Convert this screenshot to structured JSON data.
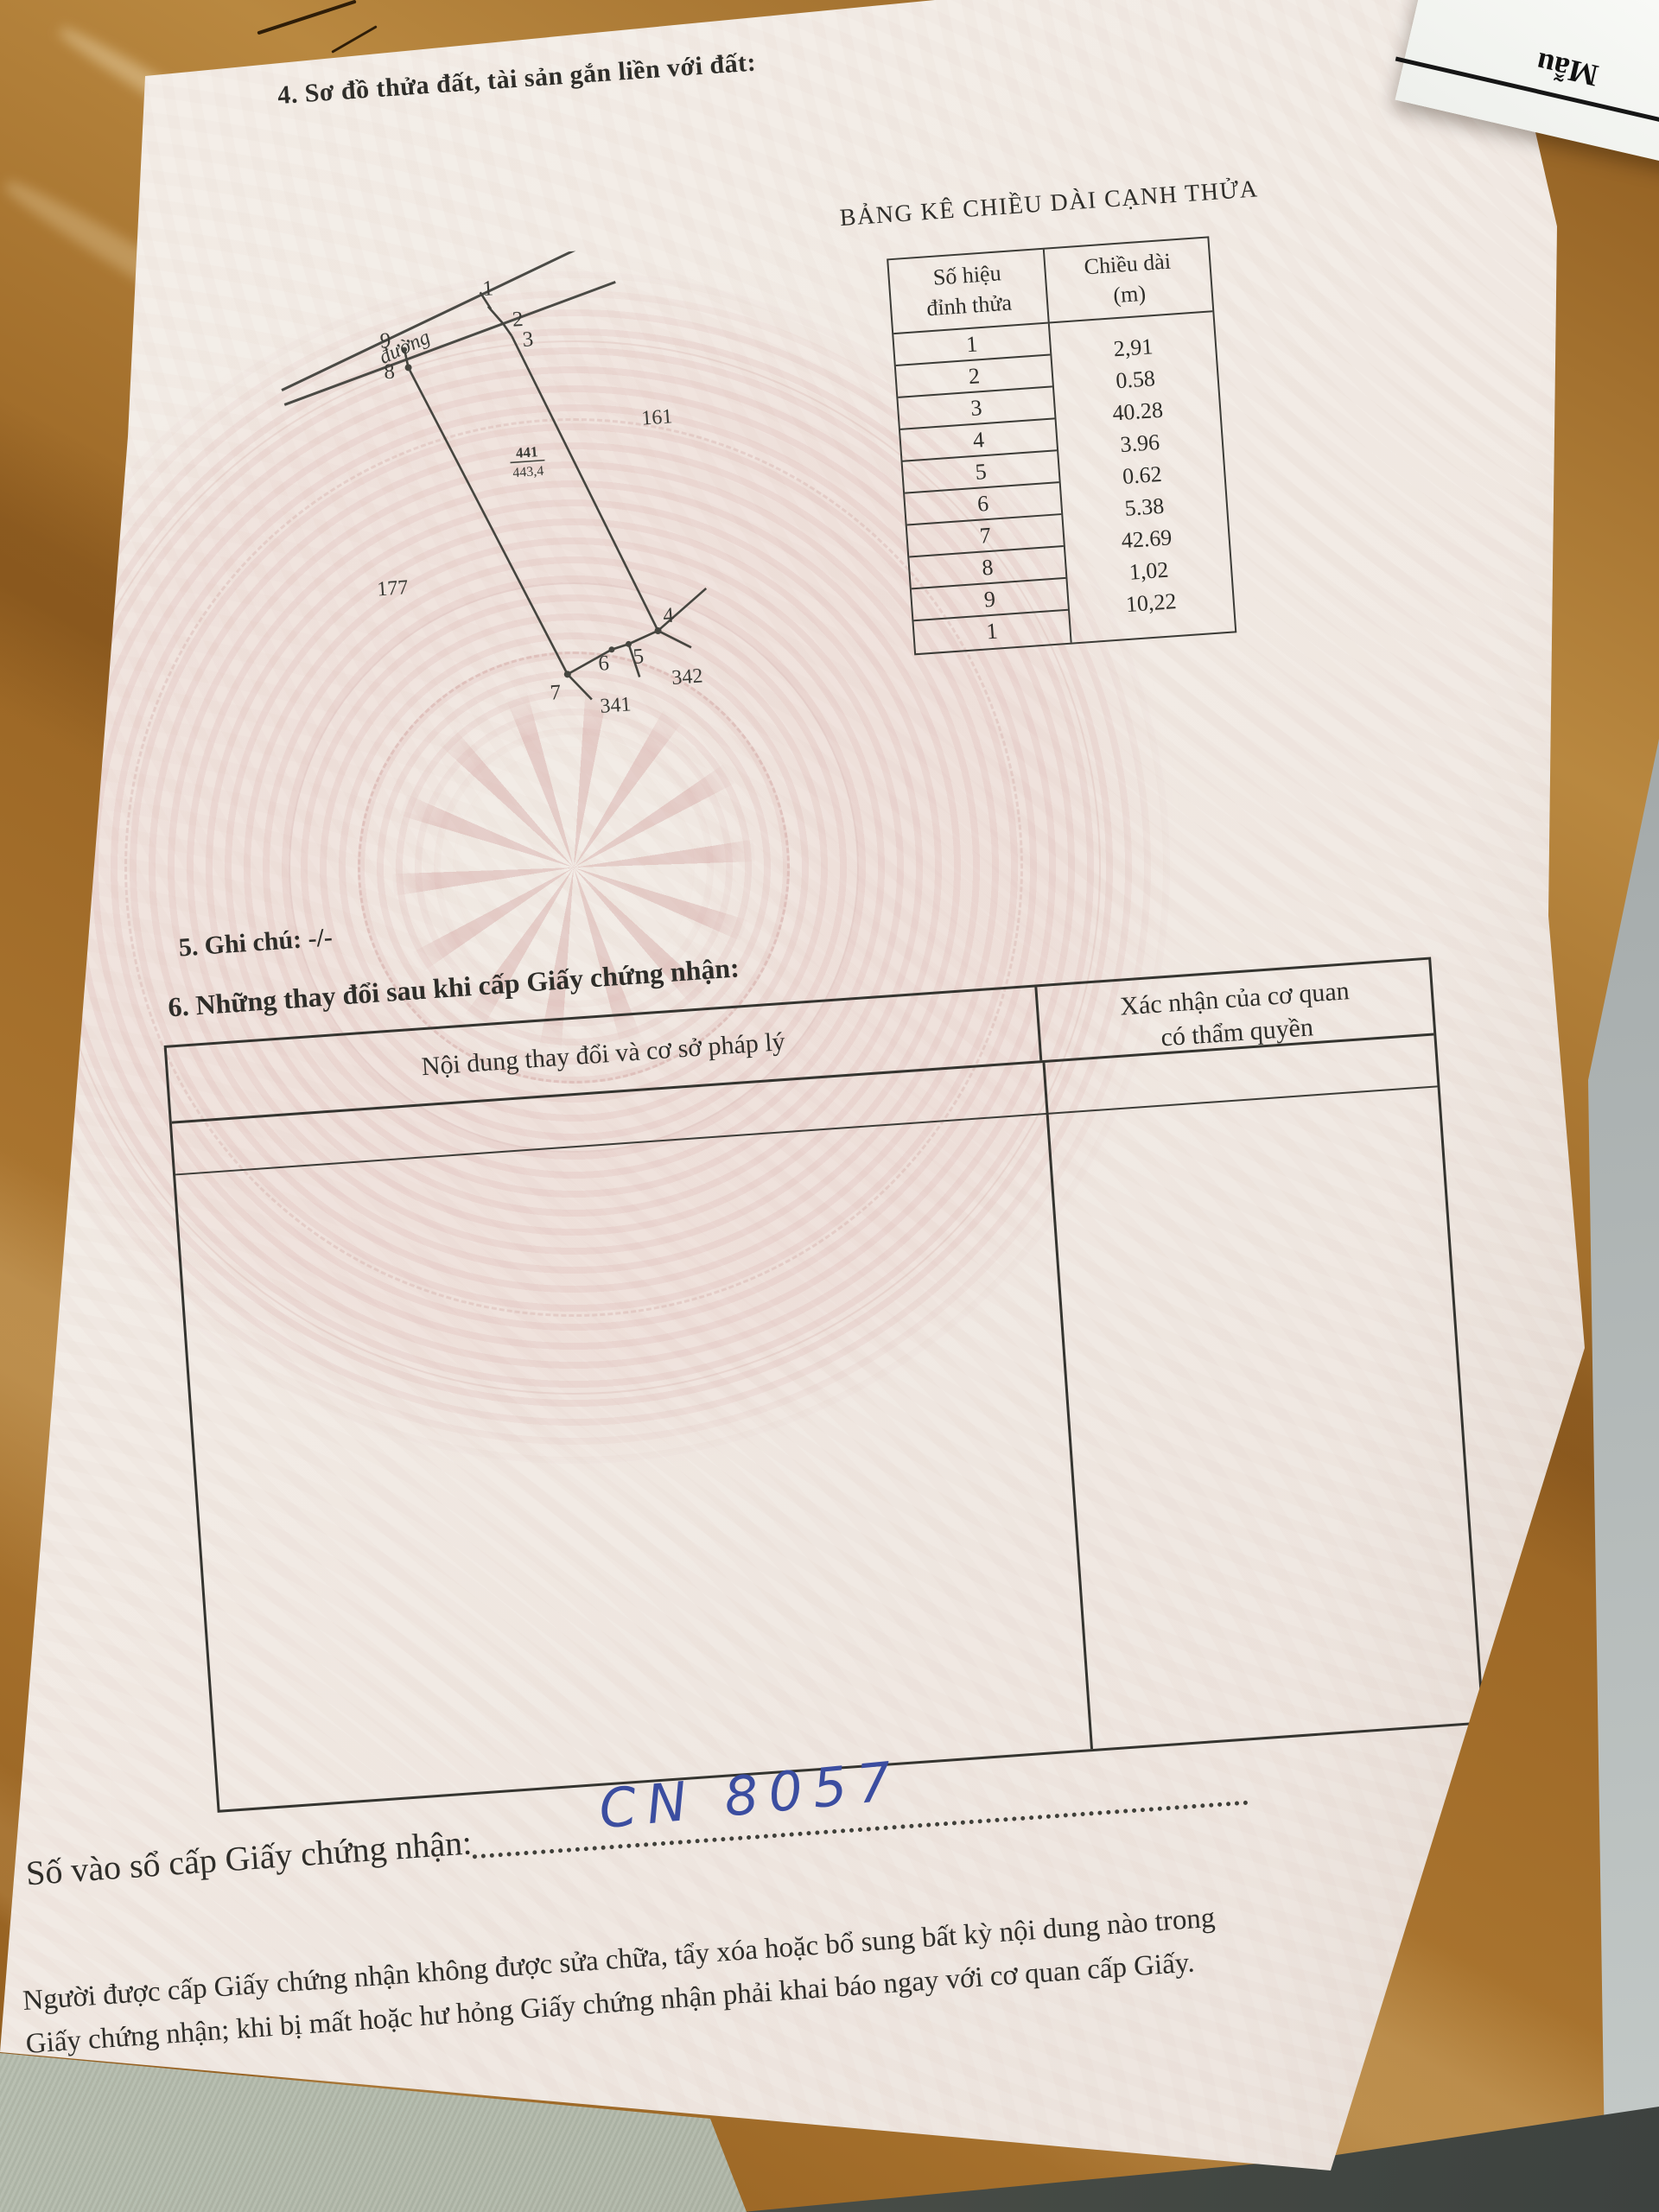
{
  "corner_card": {
    "label": "Mẫu"
  },
  "certificate": {
    "section4_heading": "4. Sơ đồ thửa đất, tài sản gắn liền với đất:",
    "length_table": {
      "title": "BẢNG KÊ CHIỀU DÀI CẠNH THỬA",
      "col1_header_line1": "Số hiệu",
      "col1_header_line2": "đỉnh thửa",
      "col2_header_line1": "Chiều dài",
      "col2_header_line2": "(m)",
      "vertices": [
        "1",
        "2",
        "3",
        "4",
        "5",
        "6",
        "7",
        "8",
        "9",
        "1"
      ],
      "lengths": [
        "2,91",
        "0.58",
        "40.28",
        "3.96",
        "0.62",
        "5.38",
        "42.69",
        "1,02",
        "10,22"
      ]
    },
    "diagram": {
      "road_label": "đường",
      "parcel_number": "441",
      "parcel_area": "443,4",
      "neighbor_right": "161",
      "neighbor_left": "177",
      "neighbor_bottom": "341",
      "neighbor_bottom_right": "342",
      "v1": "1",
      "v2": "2",
      "v3": "3",
      "v4": "4",
      "v5": "5",
      "v6": "6",
      "v7": "7",
      "v8": "8",
      "v9": "9"
    },
    "section5_text": "5. Ghi chú: -/-",
    "section6_heading": "6. Những thay đổi sau khi cấp Giấy chứng nhận:",
    "changes_table": {
      "col1_header": "Nội dung thay đổi và cơ sở pháp lý",
      "col2_header_line1": "Xác nhận của cơ quan",
      "col2_header_line2": "có thẩm quyền"
    },
    "issuance": {
      "label": "Số vào sổ cấp Giấy chứng nhận:",
      "number_handwritten": "CN 8057"
    },
    "footer_line1": "Người được cấp Giấy chứng nhận không được sửa chữa, tẩy xóa hoặc bổ sung bất kỳ nội dung nào trong",
    "footer_line2": "Giấy chứng nhận; khi bị mất hoặc hư hỏng Giấy chứng nhận phải khai báo ngay với cơ quan cấp Giấy."
  }
}
